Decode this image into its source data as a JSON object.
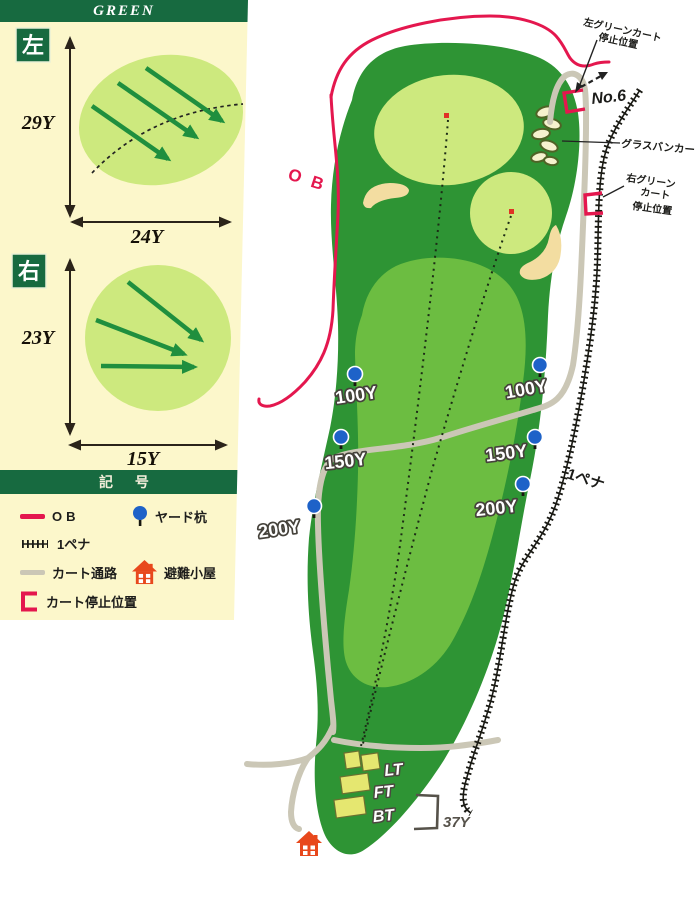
{
  "greens_panel": {
    "title": "GREEN",
    "left": {
      "badge": "左",
      "depth": "29Y",
      "width": "24Y"
    },
    "right": {
      "badge": "右",
      "depth": "23Y",
      "width": "15Y"
    }
  },
  "legend": {
    "title": "記 号",
    "items": {
      "ob": "OB",
      "yard_stake": "ヤード杭",
      "one_penalty": "1ペナ",
      "cart_path": "カート通路",
      "shelter": "避難小屋",
      "cart_stop": "カート停止位置"
    }
  },
  "map": {
    "ob_label": "O B",
    "next_hole_label": "No.6",
    "grass_bunker_label": "グラスバンカー",
    "left_green_cart_stop": {
      "line1": "左グリーンカート",
      "line2": "停止位置"
    },
    "right_green_cart_stop": {
      "line1": "右グリーン",
      "line2": "カート",
      "line3": "停止位置"
    },
    "one_penalty_label": "1ペナ",
    "yard_markers_left": {
      "y100": "100Y",
      "y150": "150Y",
      "y200": "200Y"
    },
    "yard_markers_right": {
      "y100": "100Y",
      "y150": "150Y",
      "y200": "200Y"
    },
    "tees": {
      "lt": "LT",
      "ft": "FT",
      "bt": "BT"
    },
    "tee_depth_label": "37Y"
  },
  "colors": {
    "rough_green": "#2e9434",
    "fairway_green": "#6cbd41",
    "putting_green": "#cde97e",
    "sand": "#f3dda1",
    "ob_pink": "#e4174e",
    "cart_path_gray": "#cbc7b6",
    "pin_blue": "#1e62c8",
    "house_red": "#e8481c",
    "header_green": "#176a40",
    "panel_bg": "#fcf7cb"
  }
}
